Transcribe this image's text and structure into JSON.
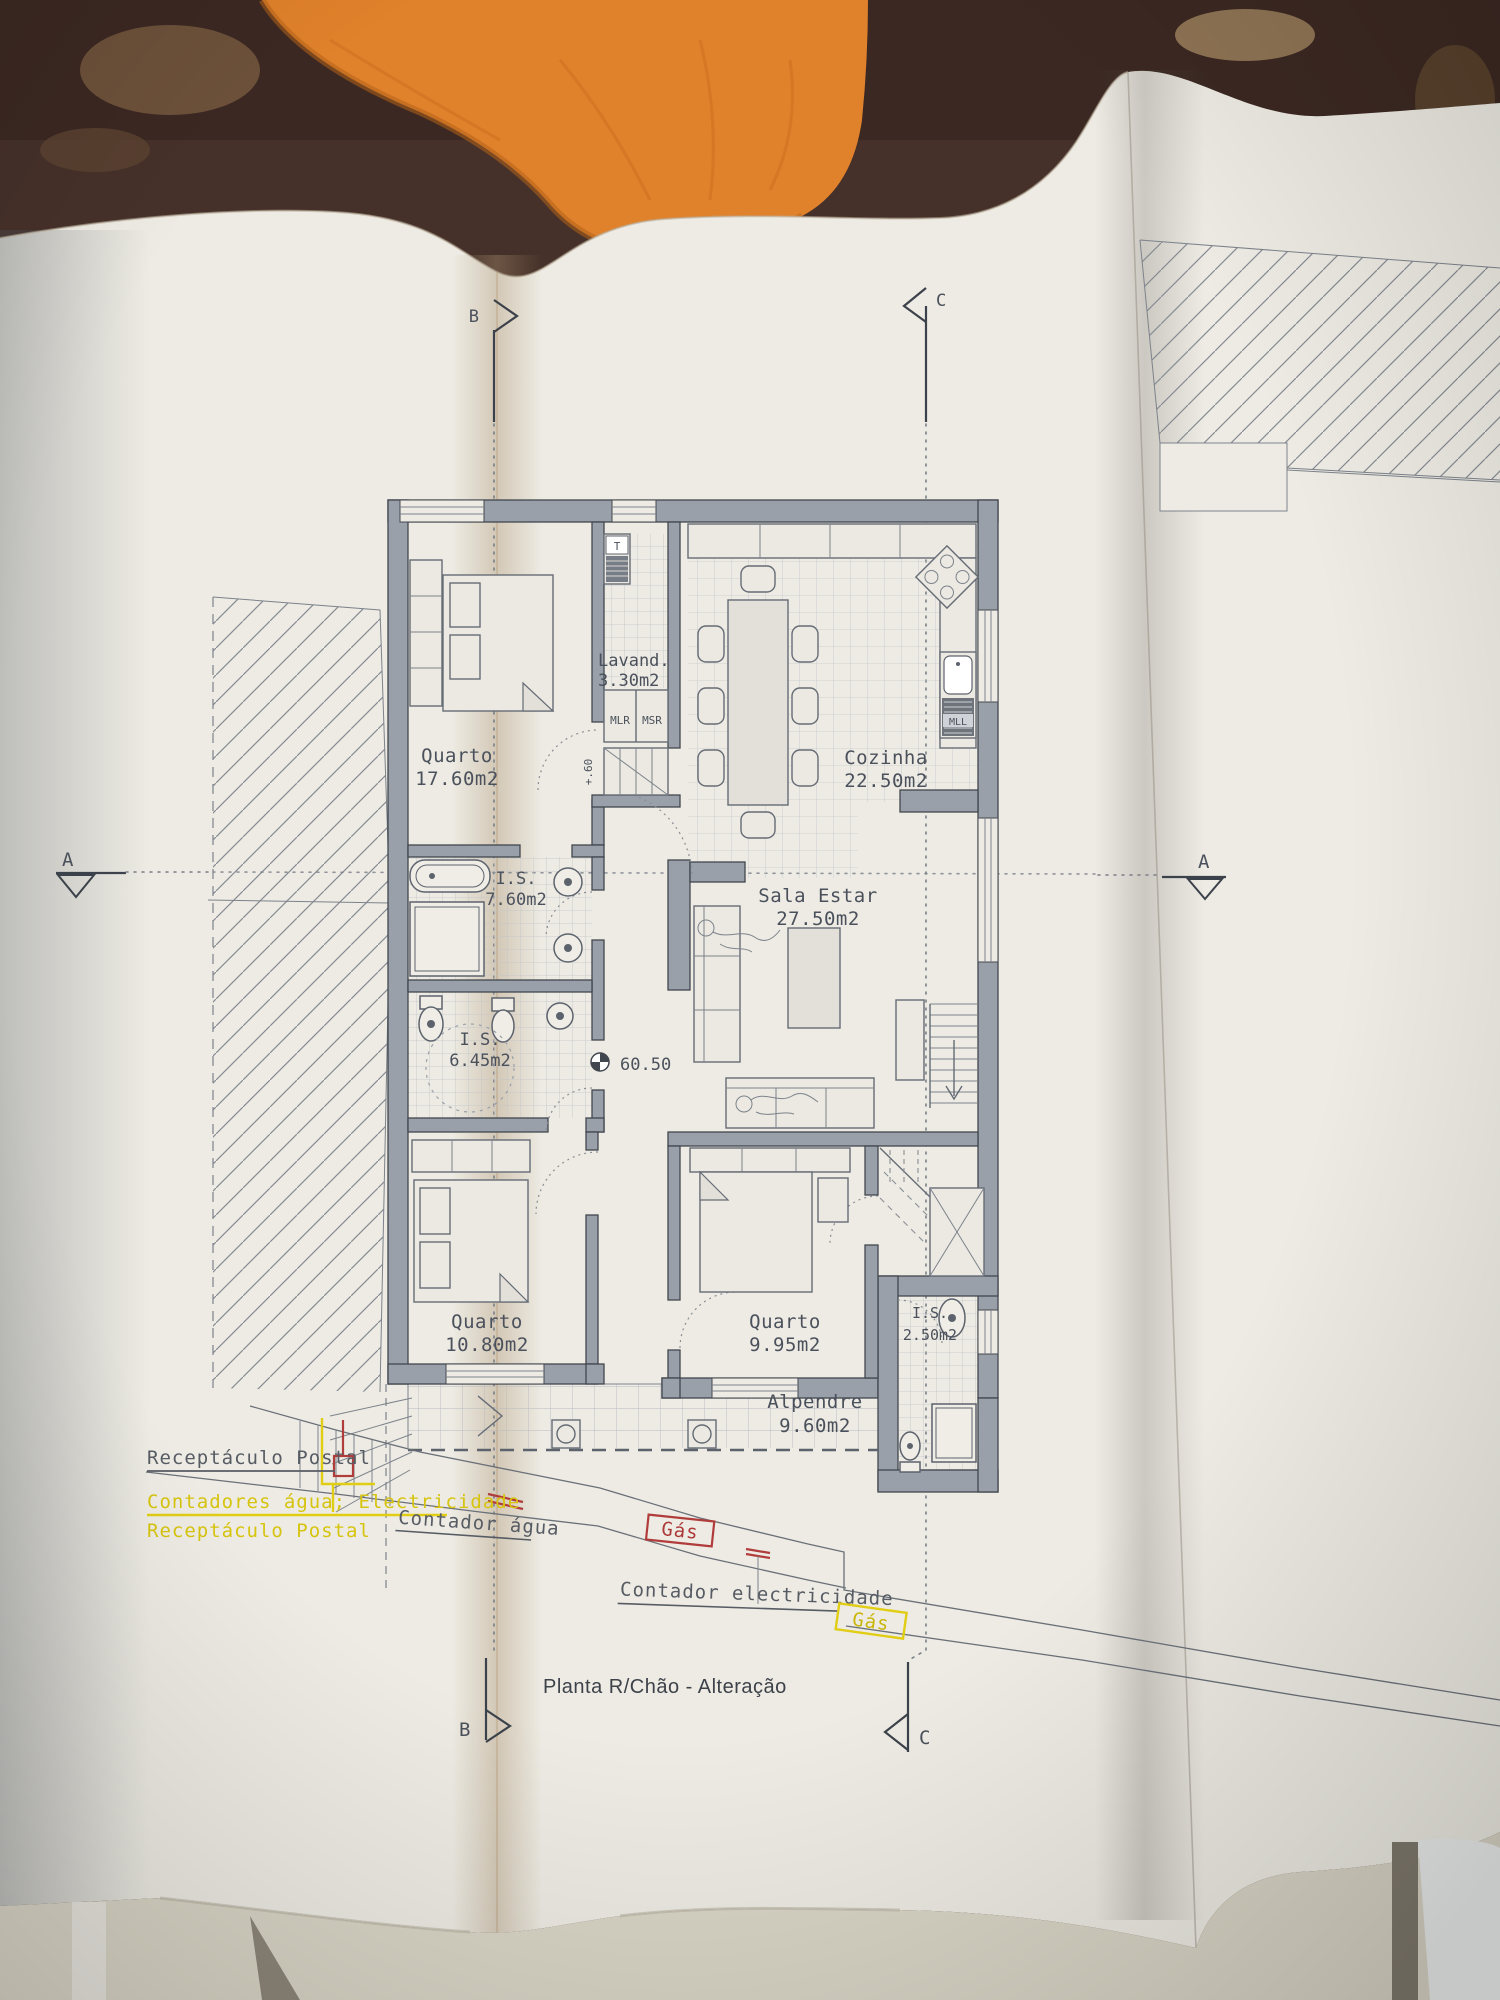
{
  "photo": {
    "background_color": "#46312a",
    "cloth_color": "#e0812b",
    "paper_color": "#edebe3",
    "undersheet_color": "#d9d5c6"
  },
  "plan": {
    "title": "Planta R/Chão - Alteração",
    "markers": {
      "a_left": "A",
      "a_right": "A",
      "b_top": "B",
      "b_bottom": "B",
      "c_top": "C",
      "c_bottom": "C"
    },
    "level_marker": "60.50",
    "step_label": "+.60",
    "rooms": {
      "quarto1": {
        "name": "Quarto",
        "area": "17.60m2"
      },
      "lavandaria": {
        "name": "Lavand.",
        "area": "3.30m2"
      },
      "cozinha": {
        "name": "Cozinha",
        "area": "22.50m2"
      },
      "is1": {
        "name": "I.S.",
        "area": "7.60m2"
      },
      "sala": {
        "name": "Sala  Estar",
        "area": "27.50m2"
      },
      "is2": {
        "name": "I.S.",
        "area": "6.45m2"
      },
      "quarto2": {
        "name": "Quarto",
        "area": "10.80m2"
      },
      "quarto3": {
        "name": "Quarto",
        "area": "9.95m2"
      },
      "is3": {
        "name": "I.S.",
        "area": "2.50m2"
      },
      "alpendre": {
        "name": "Alpendre",
        "area": "9.60m2"
      }
    },
    "appliances": {
      "t": "T",
      "mlr": "MLR",
      "msr": "MSR",
      "mll": "MLL"
    },
    "annotations": {
      "receptaculo_dark": "Receptáculo Postal",
      "contadores_yellow": "Contadores água; Electricidade",
      "receptaculo_yellow": "Receptáculo Postal",
      "contador_agua": "Contador água",
      "gas_red": "Gás",
      "contador_electricidade": "Contador electricidade",
      "gas_yellow": "Gás"
    },
    "colors": {
      "ink": "#4b515c",
      "yellow": "#d6c40e",
      "red": "#ac3838"
    }
  }
}
